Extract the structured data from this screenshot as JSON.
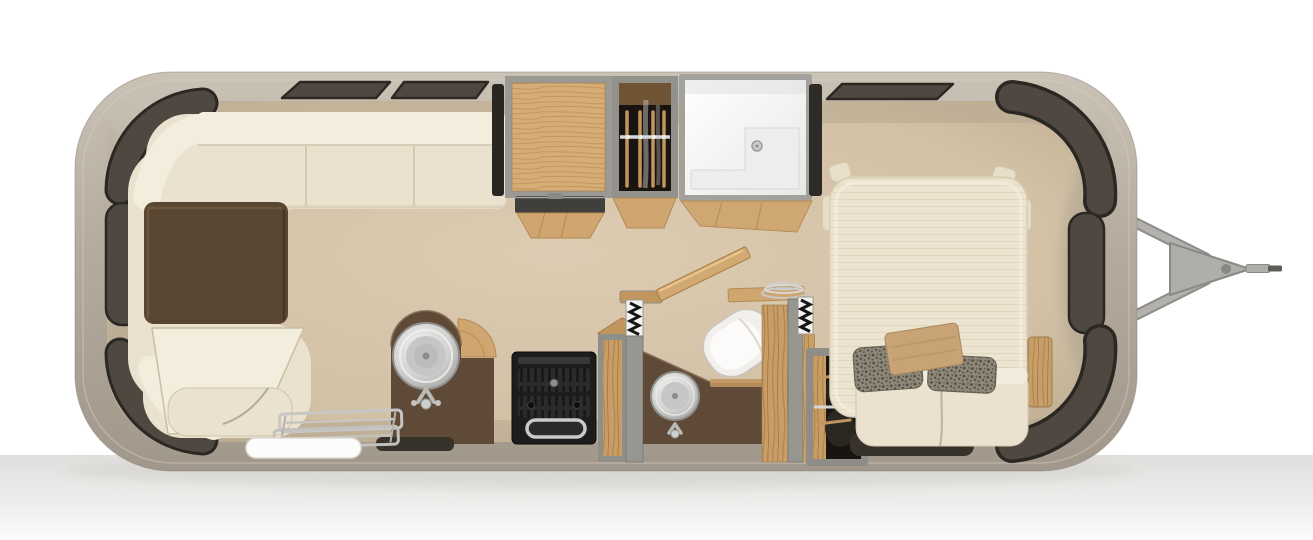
{
  "meta": {
    "description": "Top-down 3D rendered floor plan of a single-axle travel trailer with rear wraparound lounge, curbside galley, split bath, and front bedroom",
    "view": "overhead floor plan render",
    "text_content": "none — image contains no visible text"
  },
  "colors": {
    "background": "#ffffff",
    "ground_shadow": "#e0dfdd",
    "shell_top": "#cac2b5",
    "shell_mid": "#b4ab9e",
    "shell_bottom": "#a1988b",
    "shell_edge": "#8d8579",
    "floor_center": "#ddcbb2",
    "floor_mid": "#d3c1a6",
    "floor_edge": "#bfae93",
    "wall_shade": "#a79d8c",
    "window_fill": "#4e4840",
    "window_edge": "#2b2723",
    "sofa_base": "#eae2cf",
    "sofa_light": "#f3edde",
    "sofa_shadow": "#d5cab1",
    "table_top": "#5a4733",
    "counter_top": "#5e4a36",
    "wood_light": "#cfa66f",
    "wood_mid": "#b58a52",
    "wood_dark": "#a87c47",
    "steel_light": "#f0f0ee",
    "steel_mid": "#c2c2c2",
    "steel_dark": "#8f8f8d",
    "stove_body": "#1d1d1d",
    "wall_gray": "#979792",
    "wall_gray_dark": "#7b7b76",
    "shower_white": "#ffffff",
    "shower_shade": "#e8e8e6",
    "closet_dark": "#191410",
    "bed_top": "#ece4d0",
    "bed_stripe": "#e0d6bd",
    "pillow_gray": "#8d8779",
    "pillow_speck": "#4c473d",
    "pillow_accent": "#c7a376",
    "mat_dark": "#37332b",
    "door_white": "#fcfcfb",
    "hitch_gray": "#b0aeaa",
    "hitch_edge": "#8b8985"
  },
  "elements": {
    "trailer_shell": "rounded aluminum body shell",
    "lounge": "wraparound cream lounge at rear (left end) with dark brown pedestal table",
    "windows": "tinted windows: curved pairs at both ends, two slim windows above lounge, one above bed",
    "galley": "curbside galley with arched sink cabinet, stainless round sink, black range with oven handle, dark floor mat",
    "pantry": "oak-front tall cabinet beside range",
    "overhead_wood_cabinet": "wood-floored storage bay on street side",
    "wardrobe_street": "street-side wardrobe with hanger rod and clothes",
    "shower": "white shower stall with bench ledge and drain",
    "bath": "split bath with accordion doors, open wood door, toilet, round vanity sink, shelf with plates",
    "wardrobe_bedroom": "bedroom wardrobe with hanger rod and clothes",
    "bedroom": "front bedroom with cream mattress, two speckled gray pillows, tan accent pillow, foot bench, dark mat",
    "entry": "entry door (white) with fold-out metal step at curb side",
    "hitch": "A-frame hitch tongue with coupler and jack at front (right)"
  }
}
